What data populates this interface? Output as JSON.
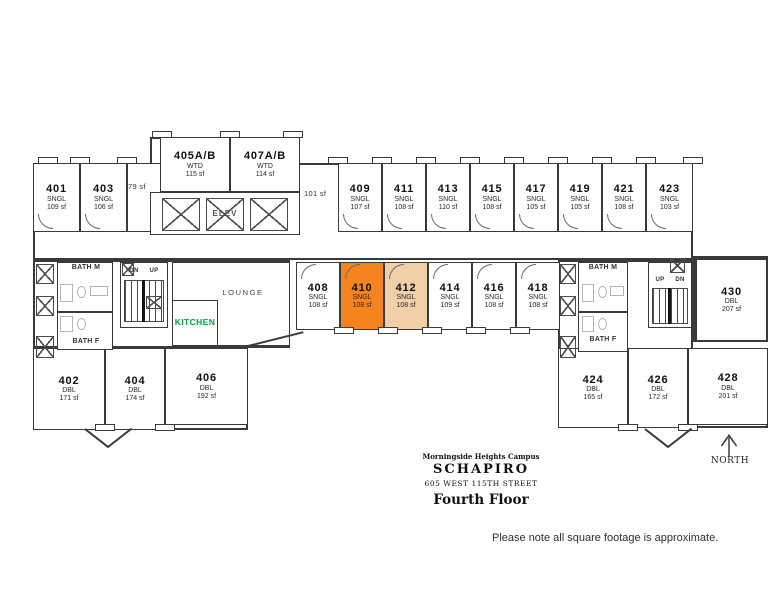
{
  "title_block": {
    "campus": "Morningside Heights Campus",
    "building": "SCHAPIRO",
    "address": "605 WEST 115TH STREET",
    "floor": "Fourth Floor"
  },
  "footnote": "Please note all square footage is approximate.",
  "compass_label": "NORTH",
  "colors": {
    "highlight_primary": "#F5831F",
    "highlight_secondary": "#F0CFA9",
    "kitchen_text": "#00A33C",
    "wall": "#3a3a3a"
  },
  "labels": {
    "lounge": "LOUNGE",
    "kitchen": "KITCHEN",
    "elevator": "ELEV",
    "bath_m": "BATH M",
    "bath_f": "BATH F",
    "up": "UP",
    "dn": "DN",
    "sf_small_room": "79 sf",
    "sf_lobby": "101 sf"
  },
  "rooms": [
    {
      "number": "401",
      "type": "SNGL",
      "area": "109 sf"
    },
    {
      "number": "403",
      "type": "SNGL",
      "area": "106 sf"
    },
    {
      "number": "405A/B",
      "type": "WTD",
      "area": "115 sf"
    },
    {
      "number": "407A/B",
      "type": "WTD",
      "area": "114 sf"
    },
    {
      "number": "409",
      "type": "SNGL",
      "area": "107 sf"
    },
    {
      "number": "411",
      "type": "SNGL",
      "area": "108 sf"
    },
    {
      "number": "413",
      "type": "SNGL",
      "area": "110 sf"
    },
    {
      "number": "415",
      "type": "SNGL",
      "area": "108 sf"
    },
    {
      "number": "417",
      "type": "SNGL",
      "area": "105 sf"
    },
    {
      "number": "419",
      "type": "SNGL",
      "area": "105 sf"
    },
    {
      "number": "421",
      "type": "SNGL",
      "area": "108 sf"
    },
    {
      "number": "423",
      "type": "SNGL",
      "area": "103 sf"
    },
    {
      "number": "408",
      "type": "SNGL",
      "area": "108 sf"
    },
    {
      "number": "410",
      "type": "SNGL",
      "area": "108 sf",
      "highlight": "primary"
    },
    {
      "number": "412",
      "type": "SNGL",
      "area": "108 sf",
      "highlight": "secondary"
    },
    {
      "number": "414",
      "type": "SNGL",
      "area": "109 sf"
    },
    {
      "number": "416",
      "type": "SNGL",
      "area": "108 sf"
    },
    {
      "number": "418",
      "type": "SNGL",
      "area": "108 sf"
    },
    {
      "number": "430",
      "type": "DBL",
      "area": "207 sf"
    },
    {
      "number": "402",
      "type": "DBL",
      "area": "171 sf"
    },
    {
      "number": "404",
      "type": "DBL",
      "area": "174 sf"
    },
    {
      "number": "406",
      "type": "DBL",
      "area": "192 sf"
    },
    {
      "number": "424",
      "type": "DBL",
      "area": "165 sf"
    },
    {
      "number": "426",
      "type": "DBL",
      "area": "172 sf"
    },
    {
      "number": "428",
      "type": "DBL",
      "area": "201 sf"
    }
  ]
}
